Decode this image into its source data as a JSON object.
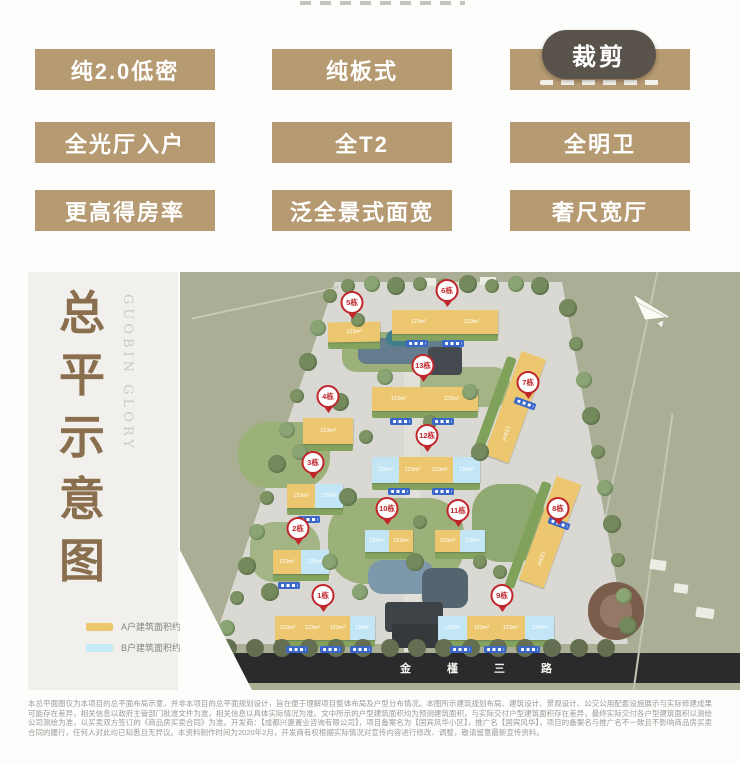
{
  "colors": {
    "badge_bg": "#b69a72",
    "crop_bg": "#59534b",
    "title_brown": "#8a6f4e",
    "pin_red": "#c0272d"
  },
  "badges": {
    "rows": [
      [
        {
          "label": "纯2.0低密"
        },
        {
          "label": "纯板式"
        },
        {
          "label": "",
          "obscured": true
        }
      ],
      [
        {
          "label": "全光厅入户"
        },
        {
          "label": "全T2"
        },
        {
          "label": "全明卫"
        }
      ],
      [
        {
          "label": "更高得房率"
        },
        {
          "label": "泛全景式面宽"
        },
        {
          "label": "奢尺宽厅"
        }
      ]
    ]
  },
  "crop_button": {
    "label": "裁剪"
  },
  "panel": {
    "title": "总平示意图",
    "subtitle": "GUOBIN GLORY"
  },
  "legend": {
    "items": [
      {
        "swatch": "#ecc76d",
        "label": "A户建筑面积约123m²"
      },
      {
        "swatch": "#c5e9f7",
        "label": "B户建筑面积约139m²"
      }
    ]
  },
  "map": {
    "street_name": [
      "金",
      "槿",
      "三",
      "路"
    ],
    "unit_colors": {
      "A": "#ecc770",
      "B": "#c2e6f5"
    },
    "area_labels": {
      "A": "123m²",
      "B": "139m²"
    },
    "buildings": [
      {
        "x": 148,
        "y": 50,
        "w": 52,
        "h": 20,
        "segs": [
          "A"
        ],
        "rot": -1
      },
      {
        "x": 212,
        "y": 38,
        "w": 106,
        "h": 24,
        "segs": [
          "A",
          "A"
        ],
        "rot": 0
      },
      {
        "x": 192,
        "y": 115,
        "w": 106,
        "h": 24,
        "segs": [
          "A",
          "A"
        ],
        "rot": 0
      },
      {
        "x": 123,
        "y": 146,
        "w": 50,
        "h": 26,
        "segs": [
          "A"
        ],
        "rot": 0
      },
      {
        "x": 322,
        "y": 80,
        "w": 26,
        "h": 110,
        "segs": [
          "A",
          "A"
        ],
        "rot": 20,
        "vertical": true
      },
      {
        "x": 192,
        "y": 185,
        "w": 108,
        "h": 26,
        "segs": [
          "B",
          "A",
          "A",
          "B"
        ],
        "rot": 0
      },
      {
        "x": 107,
        "y": 212,
        "w": 56,
        "h": 24,
        "segs": [
          "A",
          "B"
        ],
        "rot": 0
      },
      {
        "x": 185,
        "y": 258,
        "w": 48,
        "h": 22,
        "segs": [
          "B",
          "A"
        ],
        "rot": 0
      },
      {
        "x": 255,
        "y": 258,
        "w": 50,
        "h": 22,
        "segs": [
          "A",
          "B"
        ],
        "rot": 0
      },
      {
        "x": 93,
        "y": 278,
        "w": 56,
        "h": 24,
        "segs": [
          "A",
          "B"
        ],
        "rot": 0
      },
      {
        "x": 357,
        "y": 205,
        "w": 26,
        "h": 110,
        "segs": [
          "A",
          "A"
        ],
        "rot": 20,
        "vertical": true
      },
      {
        "x": 95,
        "y": 344,
        "w": 100,
        "h": 24,
        "segs": [
          "A",
          "A",
          "A",
          "B"
        ],
        "rot": 0
      },
      {
        "x": 258,
        "y": 344,
        "w": 116,
        "h": 24,
        "segs": [
          "B",
          "A",
          "A",
          "B"
        ],
        "rot": 0
      }
    ],
    "pins": [
      {
        "label": "5栋",
        "x": 172,
        "y": 52
      },
      {
        "label": "6栋",
        "x": 267,
        "y": 40
      },
      {
        "label": "13栋",
        "x": 243,
        "y": 115
      },
      {
        "label": "4栋",
        "x": 148,
        "y": 146
      },
      {
        "label": "7栋",
        "x": 348,
        "y": 132
      },
      {
        "label": "12栋",
        "x": 247,
        "y": 185
      },
      {
        "label": "3栋",
        "x": 133,
        "y": 212
      },
      {
        "label": "10栋",
        "x": 207,
        "y": 258
      },
      {
        "label": "11栋",
        "x": 278,
        "y": 260
      },
      {
        "label": "2栋",
        "x": 118,
        "y": 278
      },
      {
        "label": "8栋",
        "x": 378,
        "y": 258
      },
      {
        "label": "1栋",
        "x": 143,
        "y": 345
      },
      {
        "label": "9栋",
        "x": 322,
        "y": 345
      }
    ]
  },
  "disclaimer": "本总平面图仅为本项目的总平面布局示意，并非本项目的总平面规划设计，旨在便于理解项目整体布局及户型分布情况。本图所示建筑规划布局、建筑设计、景观设计、公交公用配套设施展示与实际修建成果可能存在差异，相关信息以政府主管部门批准文件为准，相关信息以具体实际情况为准。文中所示的户型建筑面积均为预测建筑面积，与实际交付户型建筑面积存在差异，最终实际交付各户型建筑面积以测绘公司测绘为准，以买卖双方签订的《商品房买卖合同》为准。开发商：【成都兴惠置业咨询有限公司】，项目备案名为【国宾风华小区】，推广名【国宾风华】，项目的备案名与推广名不一致且不影响商品房买卖合同的履行，任何人对此均已知悉且无异议。本资料制作时间为2020年2月，开发商有权根据实际情况对宣传内容进行修改、调整，敬请留意最新宣传资料。"
}
